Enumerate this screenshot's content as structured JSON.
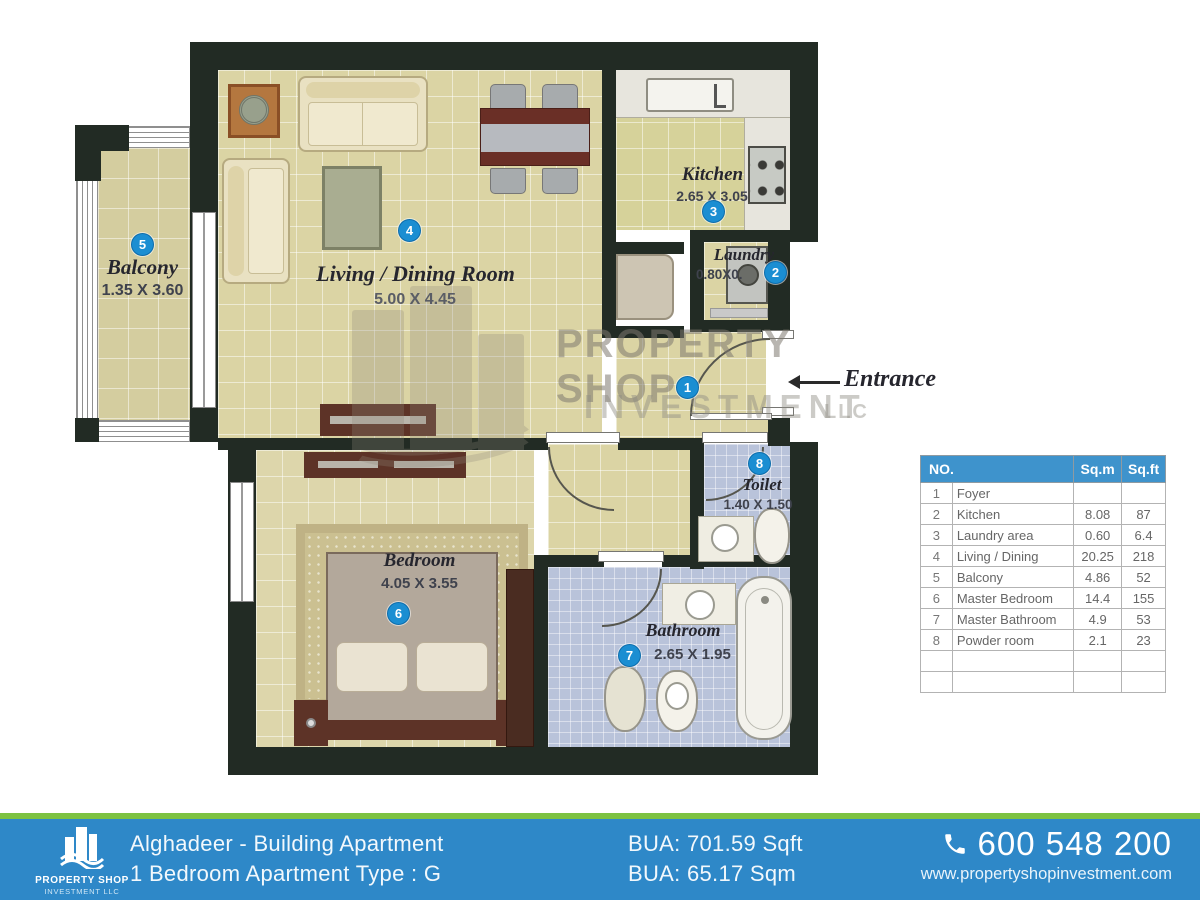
{
  "colors": {
    "wall": "#222b24",
    "floor": "#dbd4a4",
    "floor_kitchen": "#d6d29a",
    "floor_bath": "#b9c3da",
    "floor_balcony": "#d4cd9f",
    "badge_blue": "#1b8ed2",
    "table_header_blue": "#3e93cc",
    "footer_blue": "#2e88c8",
    "footer_green": "#7dc242",
    "wood_dark": "#5d3327",
    "label_dark": "#26262e"
  },
  "plan": {
    "entrance_label": "Entrance",
    "rooms": {
      "foyer": {
        "num": "1"
      },
      "laundry": {
        "num": "2",
        "name": "Laundry",
        "dims": "0.80X0."
      },
      "kitchen": {
        "num": "3",
        "name": "Kitchen",
        "dims": "2.65 X 3.05"
      },
      "living": {
        "num": "4",
        "name": "Living / Dining Room",
        "dims": "5.00 X 4.45"
      },
      "balcony": {
        "num": "5",
        "name": "Balcony",
        "dims": "1.35 X 3.60"
      },
      "bedroom": {
        "num": "6",
        "name": "Bedroom",
        "dims": "4.05 X 3.55"
      },
      "bathroom": {
        "num": "7",
        "name": "Bathroom",
        "dims": "2.65 X 1.95"
      },
      "toilet": {
        "num": "8",
        "name": "Toilet",
        "dims": "1.40 X 1.50"
      }
    },
    "watermark": {
      "line1": "PROPERTY SHOP",
      "line2": "INVESTMENT",
      "line3": "LLC"
    }
  },
  "area_table": {
    "headers": [
      "NO.",
      "Sq.m",
      "Sq.ft"
    ],
    "rows": [
      {
        "no": "1",
        "room": "Foyer",
        "sqm": "",
        "sqft": ""
      },
      {
        "no": "2",
        "room": "Kitchen",
        "sqm": "8.08",
        "sqft": "87"
      },
      {
        "no": "3",
        "room": "Laundry  area",
        "sqm": "0.60",
        "sqft": "6.4"
      },
      {
        "no": "4",
        "room": "Living / Dining",
        "sqm": "20.25",
        "sqft": "218"
      },
      {
        "no": "5",
        "room": "Balcony",
        "sqm": "4.86",
        "sqft": "52"
      },
      {
        "no": "6",
        "room": "Master Bedroom",
        "sqm": "14.4",
        "sqft": "155"
      },
      {
        "no": "7",
        "room": "Master Bathroom",
        "sqm": "4.9",
        "sqft": "53"
      },
      {
        "no": "8",
        "room": "Powder room",
        "sqm": "2.1",
        "sqft": "23"
      },
      {
        "no": "",
        "room": "",
        "sqm": "",
        "sqft": ""
      },
      {
        "no": "",
        "room": "",
        "sqm": "",
        "sqft": ""
      }
    ]
  },
  "footer": {
    "brand": {
      "line1": "PROPERTY SHOP",
      "line2": "INVESTMENT LLC"
    },
    "project_line1": "Alghadeer - Building Apartment",
    "project_line2": "1 Bedroom Apartment Type : G",
    "bua_sqft": "BUA: 701.59 Sqft",
    "bua_sqm": "BUA: 65.17 Sqm",
    "phone": "600 548 200",
    "website": "www.propertyshopinvestment.com"
  }
}
